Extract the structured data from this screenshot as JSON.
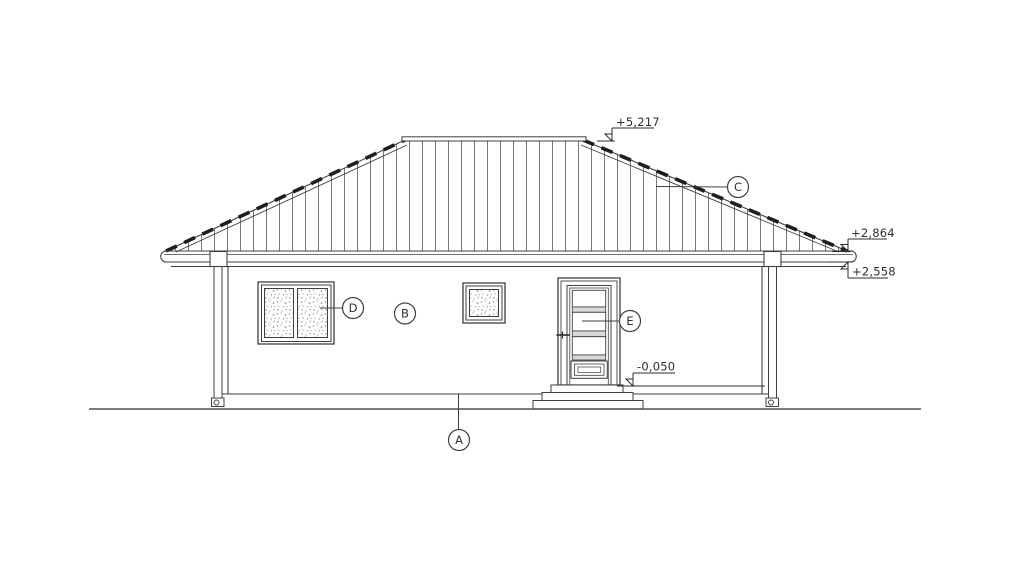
{
  "drawing": {
    "type": "architectural-elevation",
    "levels": {
      "ridge": "+5,217",
      "eave_top": "+2,864",
      "eave_bottom": "+2,558",
      "entry": "-0,050"
    },
    "reference_labels": {
      "a": "A",
      "b": "B",
      "c": "C",
      "d": "D",
      "e": "E"
    },
    "colors": {
      "line": "#3f3f3f",
      "roof_hatch": "#787878",
      "tile_edge": "#1e1e1e",
      "glass_stipple": "#8c8c8c",
      "ground": "#6a6a6a",
      "background": "#ffffff"
    }
  }
}
